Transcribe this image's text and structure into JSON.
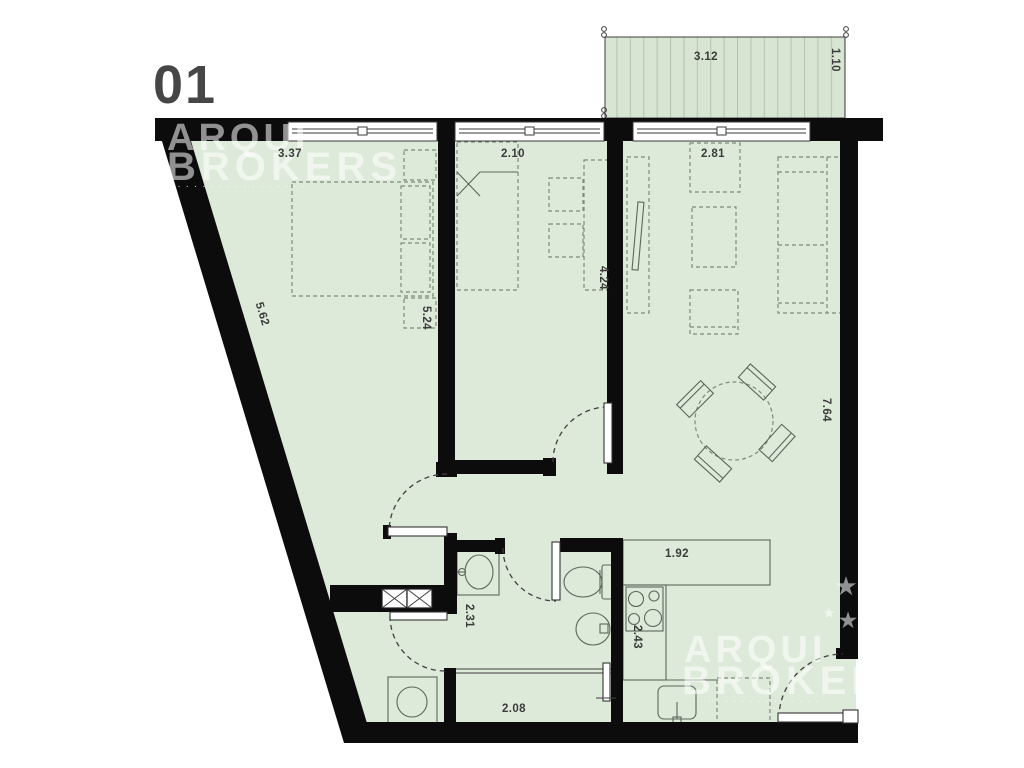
{
  "unit": {
    "number": "01"
  },
  "watermark": {
    "brand_line1": "ARQUI",
    "brand_line2": "BROKERS",
    "tagline": "· · · · · ·   · · · · · · · · · ·",
    "star": "★"
  },
  "dimensions": {
    "bedroom1_width": "3.37",
    "bedroom2_width": "2.10",
    "living_width": "2.81",
    "balcony_width": "3.12",
    "balcony_depth": "1.10",
    "left_wall_length": "5.62",
    "bedroom1_depth": "5.24",
    "bedroom2_depth": "4.24",
    "living_depth": "7.64",
    "kitchen_counter": "1.92",
    "bathroom_depth": "2.31",
    "kitchen_depth": "2.43",
    "hall_width": "2.08"
  },
  "colors": {
    "floor": "#dde9d9",
    "balcony_floor": "#d8e5d3",
    "balcony_stripe": "#b5c6b0",
    "wall": "#0c0c0c",
    "furniture_stroke": "#7e8c7b",
    "fixture_stroke": "#5a685a",
    "dimension_text": "#3b3b3b",
    "watermark": "rgba(255,255,255,0.55)",
    "watermark_tag": "rgba(255,255,255,0.75)",
    "label_gray": "#464646"
  }
}
